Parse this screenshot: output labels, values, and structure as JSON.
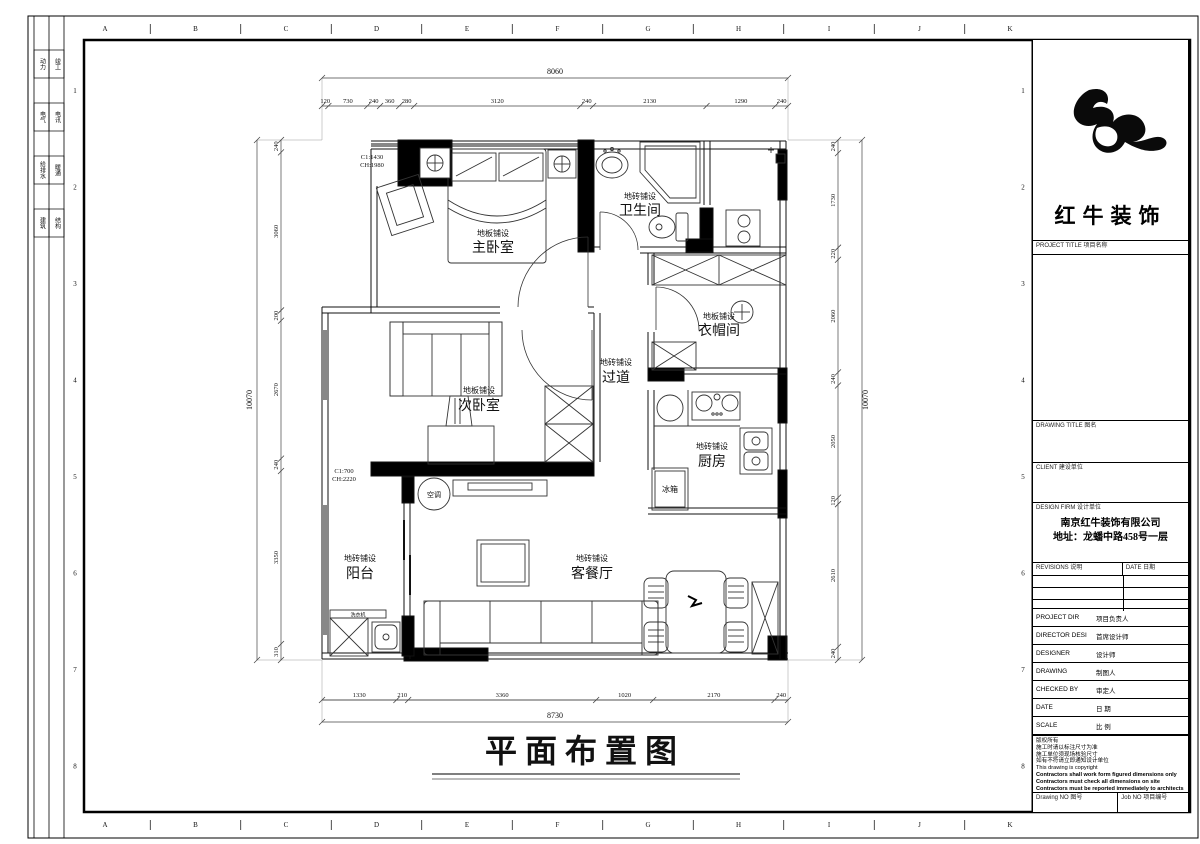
{
  "frame": {
    "grid_letters": [
      "A",
      "B",
      "C",
      "D",
      "E",
      "F",
      "G",
      "H",
      "I",
      "J",
      "K"
    ],
    "grid_numbers": [
      "1",
      "2",
      "3",
      "4",
      "5",
      "6",
      "7",
      "8"
    ],
    "disciplines": [
      [
        "动力",
        "竣工"
      ],
      [
        "电气",
        "电讯"
      ],
      [
        "给排水",
        "暖通"
      ],
      [
        "建筑",
        "结构"
      ]
    ]
  },
  "plan": {
    "title": "平面布置图",
    "rooms": [
      {
        "name": "主卧室",
        "finish": "地板铺设"
      },
      {
        "name": "卫生间",
        "finish": "地砖铺设"
      },
      {
        "name": "衣帽间",
        "finish": "地板铺设"
      },
      {
        "name": "过道",
        "finish": "地砖铺设"
      },
      {
        "name": "次卧室",
        "finish": "地板铺设"
      },
      {
        "name": "厨房",
        "finish": "地砖铺设"
      },
      {
        "name": "客餐厅",
        "finish": "地砖铺设"
      },
      {
        "name": "阳台",
        "finish": "地砖铺设"
      }
    ],
    "annotations": {
      "ac": "空调",
      "fridge": "冰箱",
      "washer": "洗衣机",
      "window1": "C1:1430",
      "window1_h": "CH:1980",
      "window2": "C1:700",
      "window2_h": "CH:2220"
    },
    "dimensions": {
      "top_total": "8060",
      "top": [
        "120",
        "730",
        "240",
        "360",
        "280",
        "3120",
        "240",
        "2130",
        "1290",
        "240"
      ],
      "bottom_total": "8730",
      "bottom": [
        "1330",
        "210",
        "3360",
        "1020",
        "2170",
        "240"
      ],
      "left_total": "10070",
      "left": [
        "240",
        "3060",
        "200",
        "2670",
        "240",
        "3350",
        "310"
      ],
      "right_total": "10070",
      "right": [
        "240",
        "1730",
        "220",
        "2060",
        "240",
        "2050",
        "120",
        "2610",
        "240"
      ]
    }
  },
  "titleblock": {
    "brand": "红牛装饰",
    "project_title": "PROJECT TITLE 项目名称",
    "drawing_title": "DRAWING TITLE 图名",
    "client": "CLIENT 建设单位",
    "design_firm": "DESIGN FIRM 设计单位",
    "firm_name": "南京红牛装饰有限公司",
    "firm_address": "地址：龙蟠中路458号一层",
    "revisions": "REVISIONS 说明",
    "rev_date": "DATE 日期",
    "rows": [
      {
        "en": "PROJECT DIR",
        "zh": "项目负责人"
      },
      {
        "en": "DIRECTOR DESI",
        "zh": "首席设计师"
      },
      {
        "en": "DESIGNER",
        "zh": "设计师"
      },
      {
        "en": "DRAWING",
        "zh": "制图人"
      },
      {
        "en": "CHECKED BY",
        "zh": "审定人"
      },
      {
        "en": "DATE",
        "zh": "日 期"
      },
      {
        "en": "SCALE",
        "zh": "比 例"
      }
    ],
    "copyright": [
      "版权所有",
      "施工时请以标注尺寸为准",
      "施工单位须现场核验尺寸",
      "如有不符请立即通知设计单位",
      "This drawing is copyright",
      "Contractors shall work form figured dimensions only",
      "Contractors must check all dimensions on site",
      "Contractors must be reported immediately to architects"
    ],
    "drawing_no": "Drawing NO 图号",
    "job_no": "Job NO 项目编号"
  }
}
